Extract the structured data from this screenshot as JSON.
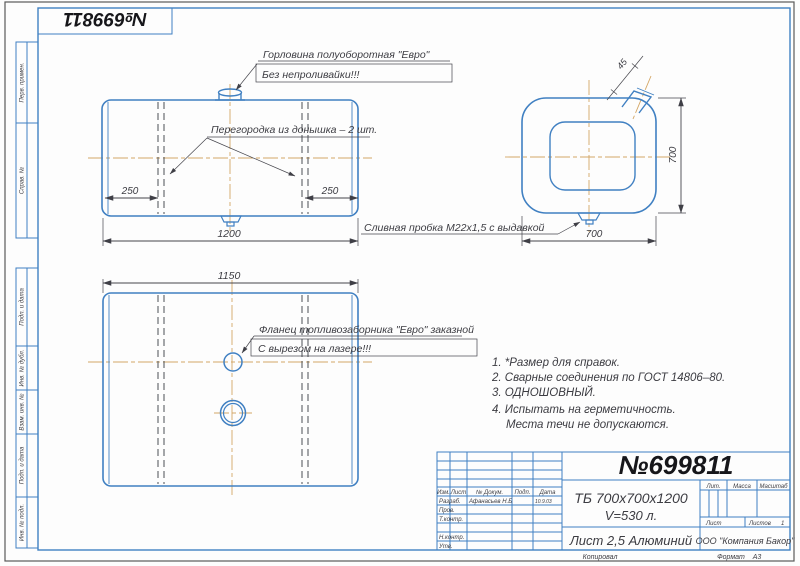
{
  "colors": {
    "line_blue": "#4080c2",
    "centerline": "#d4a766",
    "ink": "#3c3c42"
  },
  "stamp": {
    "number": "№699811"
  },
  "margin_labels": [
    "Перв. примен.",
    "Справ. №",
    "Подп. и дата",
    "Инв. № дубл.",
    "Взам. инв. №",
    "Подп. и дата",
    "Инв. № подл."
  ],
  "annotations": {
    "neck_title": "Горловина полуоборотная \"Евро\"",
    "neck_warning": "Без непроливайки!!!",
    "baffle": "Перегородка из донышка – 2 шт.",
    "drain": "Сливная пробка М22х1,5 с выдавкой",
    "flange_title": "Фланец топливозаборника \"Евро\" заказной",
    "flange_note": "С вырезом на лазере!!!"
  },
  "dimensions": {
    "baffle_left": "250",
    "baffle_right": "250",
    "tank_length": "1200",
    "shell_length": "1150",
    "side_height": "700",
    "side_width": "700",
    "neck_angle": "45"
  },
  "notes": [
    "1. *Размер для справок.",
    "2. Сварные соединения по ГОСТ 14806–80.",
    "3. ОДНОШОВНЫЙ.",
    "4. Испытать на герметичность.",
    "Места течи не допускаются."
  ],
  "title_block": {
    "number": "№699811",
    "designation": "ТБ 700х700х1200",
    "volume": "V=530 л.",
    "material": "Лист 2,5 Алюминий",
    "company": "ООО \"Компания Бакор\"",
    "col_izm": "Изм.",
    "col_list": "Лист",
    "col_doc": "№ Докум.",
    "col_podp": "Подп.",
    "col_data": "Дата",
    "row_razrab": "Разраб.",
    "razrab_name": "Афанасьев Н.Б",
    "razrab_date": "10.9.03",
    "row_prov": "Пров.",
    "row_tkontr": "Т.контр.",
    "row_nkontr": "Н.контр.",
    "row_utv": "Утв.",
    "lit": "Лит.",
    "massa": "Масса",
    "masshtab": "Масштаб",
    "list_label": "Лист",
    "listov_label": "Листов",
    "listov_value": "1",
    "kopiroval": "Копировал",
    "format_label": "Формат",
    "format_value": "А3"
  }
}
